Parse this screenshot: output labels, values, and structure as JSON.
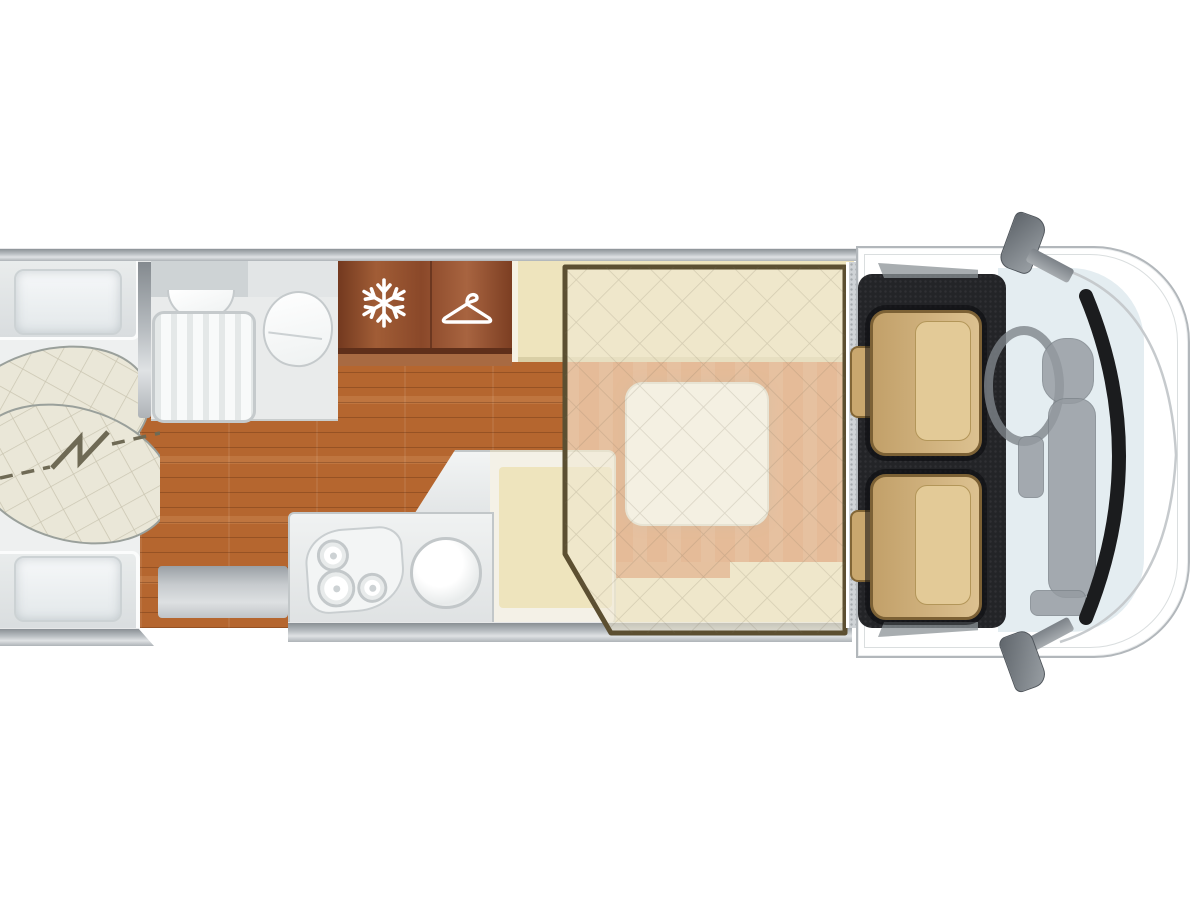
{
  "scene": {
    "type": "motorhome-floorplan-top-view",
    "background": "#ffffff",
    "visible_text": []
  },
  "colors": {
    "rearFloor": "#eef0f0",
    "bathFloor": "#e9ebeb",
    "counterGray": "#ced3d5",
    "panelGray": "#e2e5e6",
    "fixtureBorder": "#c5cacc",
    "wood": "#b5662f",
    "cabinetWood": "#8a4829",
    "cream": "#eae7d8",
    "beige": "#eee4bd",
    "salmon": "#d4763f",
    "tableWhite": "#fbfbf7",
    "overlayFill": "rgba(240,234,211,0.60)",
    "overlayBorder": "#5c4f31",
    "stepGray": "#cfd3d6",
    "carpet": "#232427",
    "seatTan": "#d5b983",
    "seatTanDark": "#7c6135",
    "dashGray": "#959ba1",
    "windshield": "#e4edf1",
    "windshieldArc": "#1b1c1e",
    "bodyOutline": "#b2b7bb",
    "wallGray": "#969ca1"
  },
  "icons": [
    {
      "name": "snowflake-icon",
      "meaning": "refrigerator",
      "color": "#ffffff"
    },
    {
      "name": "hanger-icon",
      "meaning": "wardrobe",
      "color": "#ffffff"
    },
    {
      "name": "bed-split-bolt-icon",
      "meaning": "convertible twin/double rear bed",
      "color": "#6f6a55"
    }
  ],
  "areas": [
    {
      "name": "rear-bed-area",
      "features": [
        "top-pillow",
        "bottom-pillow",
        "crossed-quilted-mattresses",
        "dashed-split-line"
      ]
    },
    {
      "name": "bathroom",
      "features": [
        "washbasin",
        "shower-tray",
        "toilet"
      ]
    },
    {
      "name": "fridge-cabinet",
      "icon": "snowflake-icon"
    },
    {
      "name": "wardrobe-cabinet",
      "icon": "hanger-icon"
    },
    {
      "name": "kitchen",
      "features": [
        "three-burner-hob",
        "round-sink",
        "l-shaped-counter"
      ]
    },
    {
      "name": "dinette",
      "features": [
        "top-bench",
        "bottom-l-bench",
        "white-table",
        "salmon-cushions"
      ]
    },
    {
      "name": "drop-down-bed-overlay",
      "style": "translucent quilted panel with dark border, chamfered bottom-left corner"
    },
    {
      "name": "entry-step"
    },
    {
      "name": "cab",
      "features": [
        "driver-seat",
        "passenger-seat",
        "steering-wheel",
        "dashboard",
        "windshield",
        "side-mirrors",
        "black-carpet"
      ]
    }
  ]
}
